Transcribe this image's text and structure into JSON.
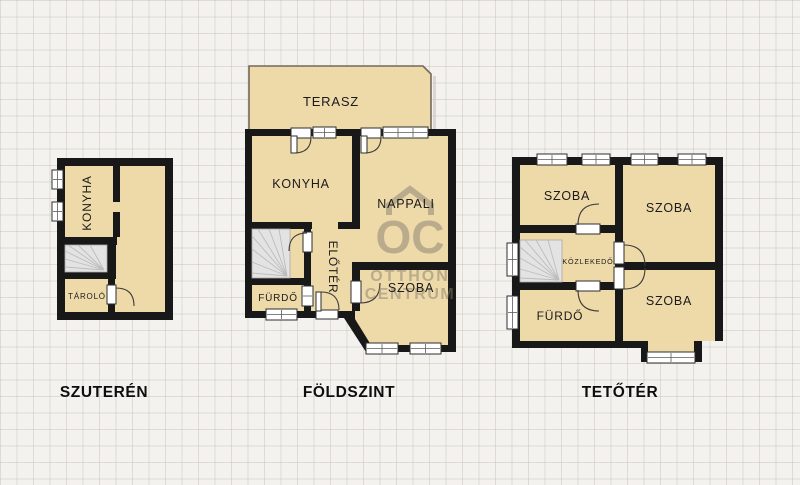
{
  "watermark": {
    "icon": "house-roof-icon",
    "initials": "OC",
    "line1": "OTTHON",
    "line2": "CENTRUM",
    "color": "#867f6e"
  },
  "colors": {
    "background": "#f4f2ee",
    "grid_line": "#b8b6ac",
    "room_fill": "#eed9a9",
    "wall": "#181818",
    "stairs_fill": "#e3e3e3",
    "terrace_border": "#75695a",
    "opening_white": "#ffffff"
  },
  "floors": {
    "basement": {
      "caption": "SZUTERÉN",
      "labels": {
        "konyha": "KONYHA",
        "tarolo": "TÁROLÓ"
      }
    },
    "ground": {
      "caption": "FÖLDSZINT",
      "labels": {
        "terasz": "TERASZ",
        "konyha": "KONYHA",
        "nappali": "NAPPALI",
        "eloter": "ELŐTÉR",
        "furdo": "FÜRDŐ",
        "szoba": "SZOBA"
      }
    },
    "attic": {
      "caption": "TETŐTÉR",
      "labels": {
        "szoba_top_left": "SZOBA",
        "szoba_top_right": "SZOBA",
        "kozlekedo": "KÖZLEKEDŐ",
        "furdo": "FÜRDŐ",
        "szoba_bottom": "SZOBA"
      }
    }
  }
}
